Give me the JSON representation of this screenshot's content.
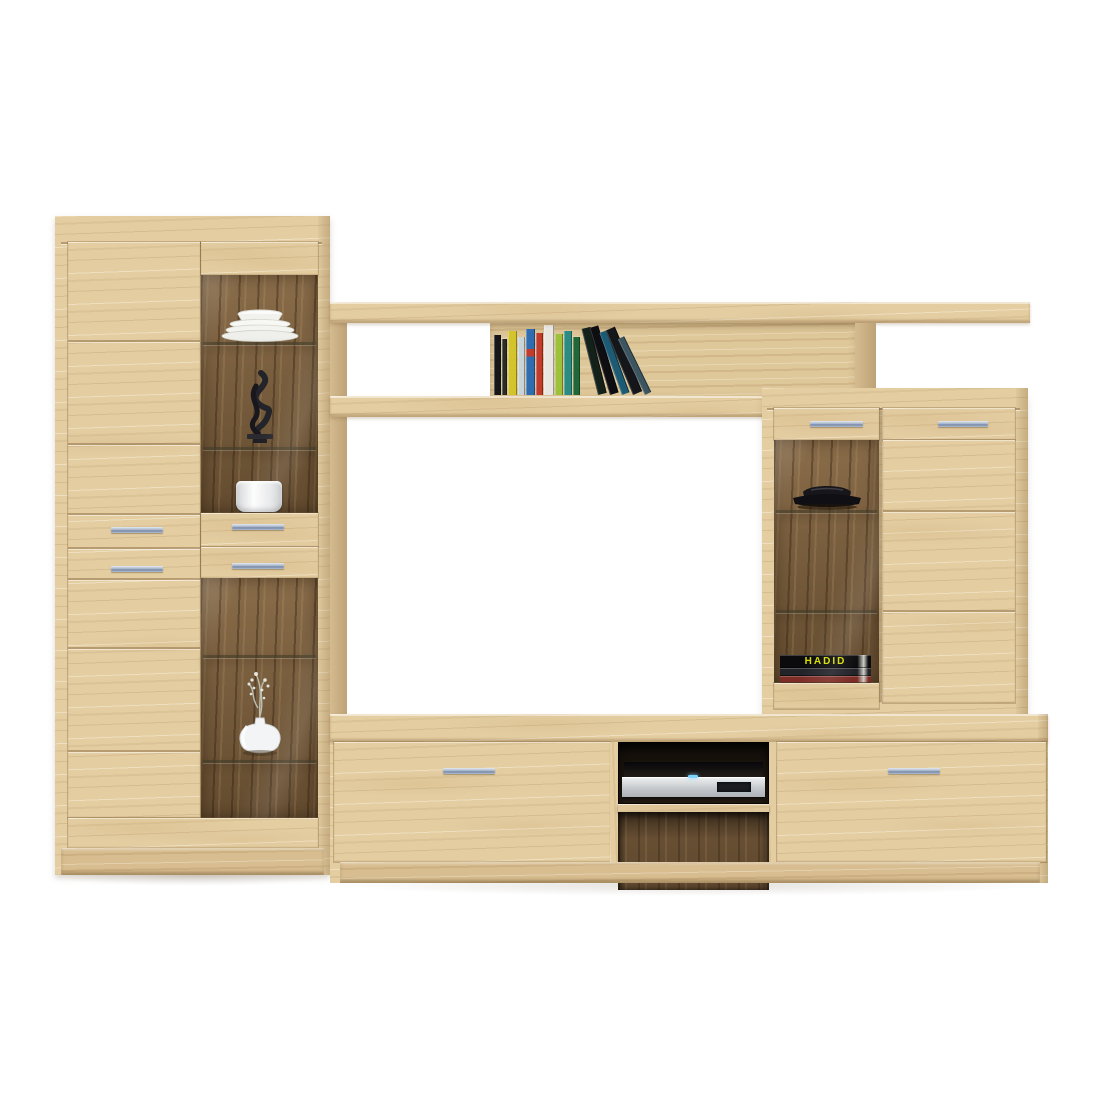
{
  "scene": {
    "description": "Product photo of a light oak living-room wall unit (display cabinets, bridge shelf with books, TV stand with media player) on a white background"
  },
  "palette": {
    "wood_mid": "#e3cda1",
    "wood_light": "#ecd9b0",
    "wood_deep": "#d7bd8f",
    "wood_edge": "#c8ab7c",
    "interior": "#7c5e3b",
    "handle_silver": "#a5b2c8",
    "glass_line": "#45412c",
    "background": "#ffffff"
  },
  "left_cabinet": {
    "handles": 4,
    "decor": {
      "plates": "stack of white plates",
      "sculpture": "black abstract sculpture",
      "pot": "white ceramic pot",
      "vase": "white vase with dried branch"
    }
  },
  "top_shelf": {
    "standing_books": [
      {
        "color": "#17171a",
        "w": 7,
        "h": 60
      },
      {
        "color": "#2a2c26",
        "w": 5,
        "h": 56
      },
      {
        "color": "#d3c42e",
        "w": 9,
        "h": 64
      },
      {
        "color": "#c9d4da",
        "w": 7,
        "h": 58
      },
      {
        "color": "#2f6db0",
        "w": 9,
        "h": 66,
        "band": "#c23b2f"
      },
      {
        "color": "#c23b2f",
        "w": 7,
        "h": 62
      },
      {
        "color": "#e9e7e0",
        "w": 10,
        "h": 70
      },
      {
        "color": "#9dc13d",
        "w": 8,
        "h": 61
      },
      {
        "color": "#2c8c84",
        "w": 8,
        "h": 64
      },
      {
        "color": "#20683a",
        "w": 7,
        "h": 58
      }
    ],
    "leaning_books": [
      {
        "color": "#14211b",
        "w": 9,
        "h": 68,
        "angle": -14,
        "left": 108
      },
      {
        "color": "#0d0d12",
        "w": 9,
        "h": 70,
        "angle": -17,
        "left": 120
      },
      {
        "color": "#1d5a74",
        "w": 8,
        "h": 66,
        "angle": -20,
        "left": 132
      },
      {
        "color": "#15161a",
        "w": 10,
        "h": 70,
        "angle": -23,
        "left": 143
      },
      {
        "color": "#3c5560",
        "w": 7,
        "h": 62,
        "angle": -26,
        "left": 155
      }
    ]
  },
  "right_cabinet": {
    "handles": 2,
    "decor": {
      "bowl": "black decorative bowl"
    },
    "book_stack": [
      {
        "label": "HADID",
        "color": "#0b0b0d",
        "label_color": "#d6df00"
      },
      {
        "color": "#23232a"
      },
      {
        "color": "#7e2d26"
      }
    ]
  },
  "tv_stand": {
    "handles": 2,
    "dvd_player": "black and silver media player"
  }
}
